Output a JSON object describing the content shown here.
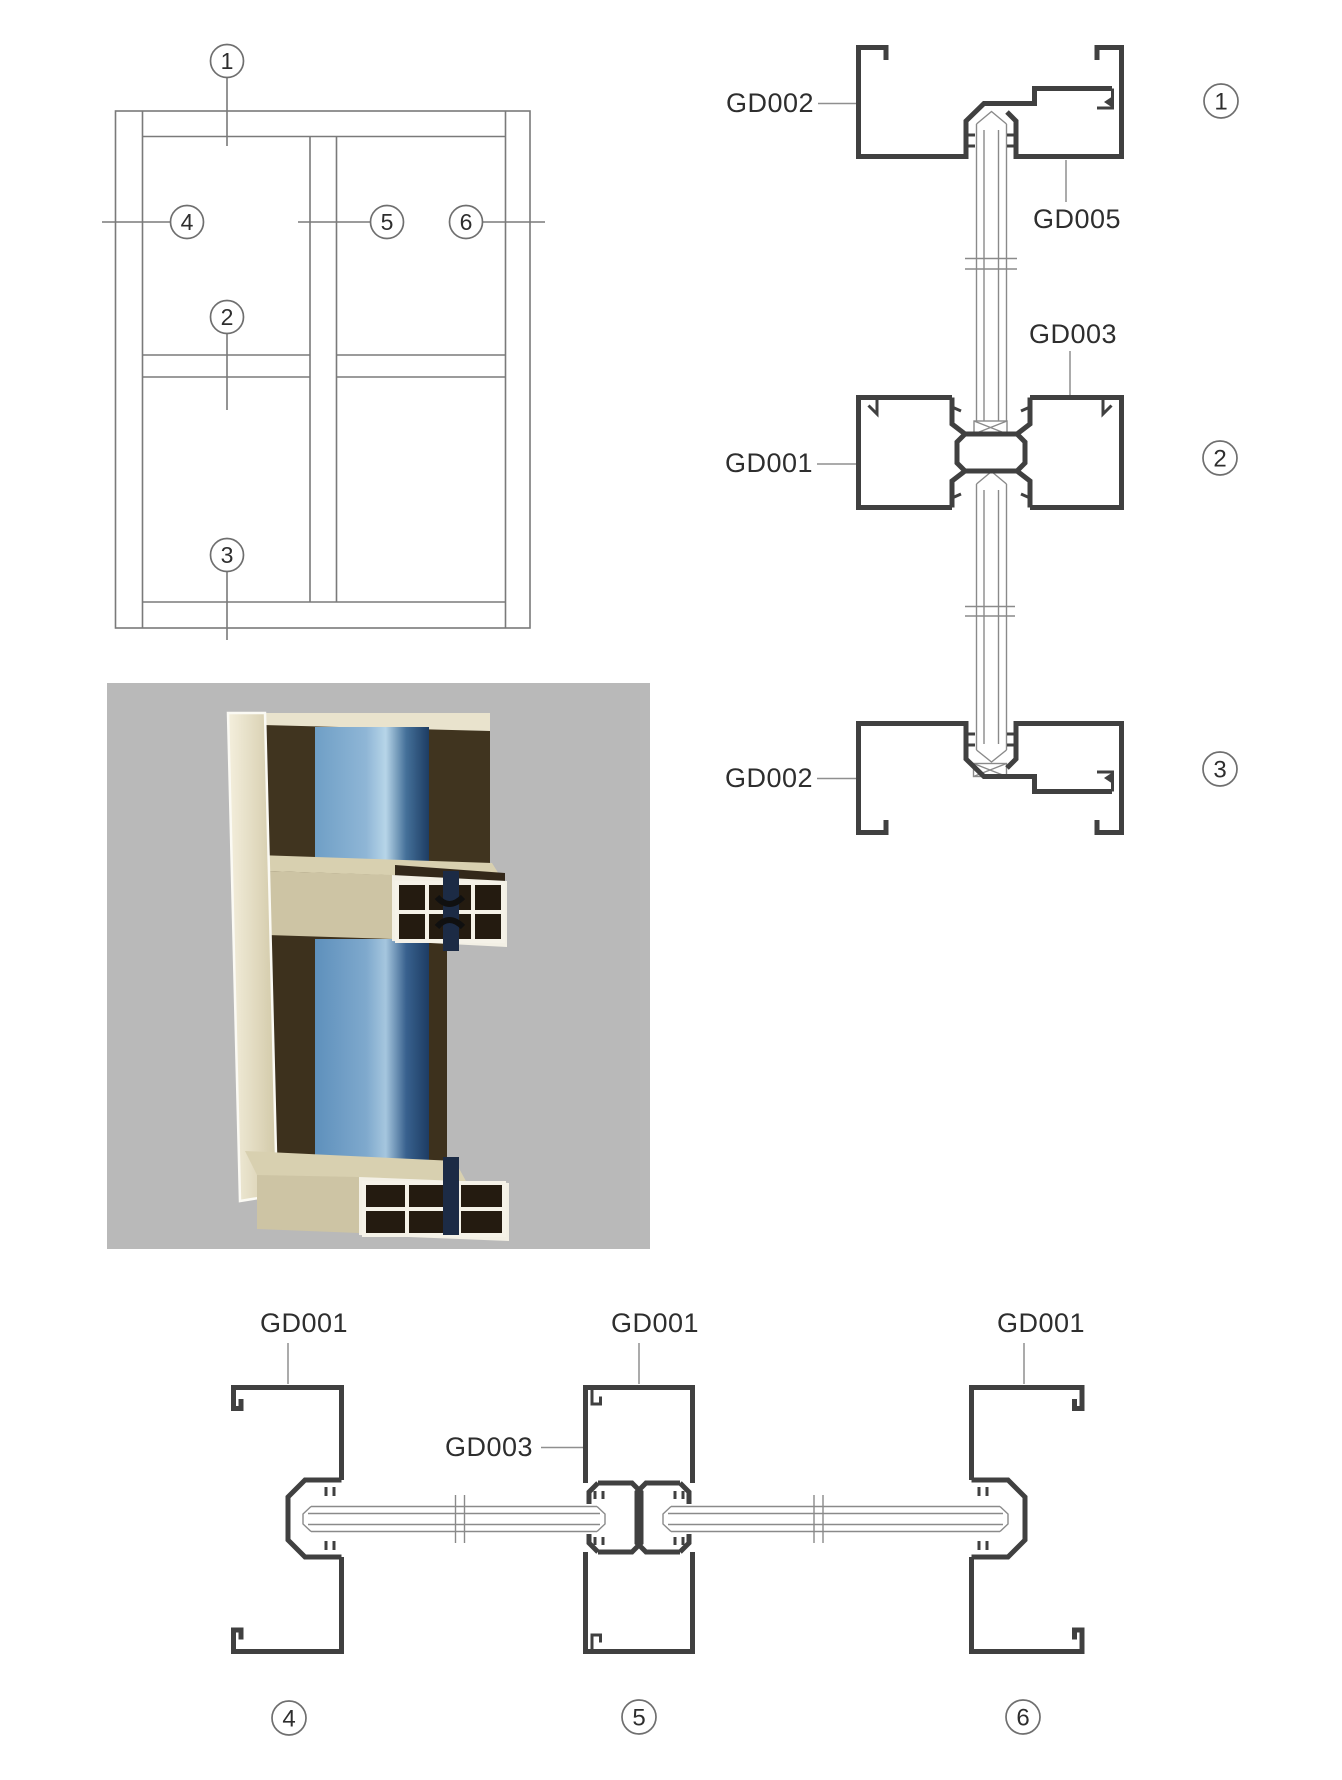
{
  "elevation": {
    "callouts": {
      "c1": "1",
      "c2": "2",
      "c3": "3",
      "c4": "4",
      "c5": "5",
      "c6": "6"
    }
  },
  "details": {
    "d1": {
      "callout": "1",
      "label_left": "GD002",
      "label_right": "GD005"
    },
    "d2": {
      "callout": "2",
      "label_left": "GD001",
      "label_top": "GD003"
    },
    "d3": {
      "callout": "3",
      "label_left": "GD002"
    },
    "d4": {
      "callout": "4",
      "label_top": "GD001"
    },
    "d5": {
      "callout": "5",
      "label_top": "GD001",
      "label_left": "GD003"
    },
    "d6": {
      "callout": "6",
      "label_top": "GD001"
    }
  },
  "colors": {
    "profile_stroke": "#404040",
    "thin_line": "#7a7a7a",
    "photo_background": "#b9b9b9",
    "frame_beige": "#d8d0b0",
    "frame_beige_light": "#efe9d4",
    "glass_blue": "#5e90bc",
    "glass_blue_light": "#b7d5e8",
    "glass_blue_dark": "#1d3c63"
  }
}
